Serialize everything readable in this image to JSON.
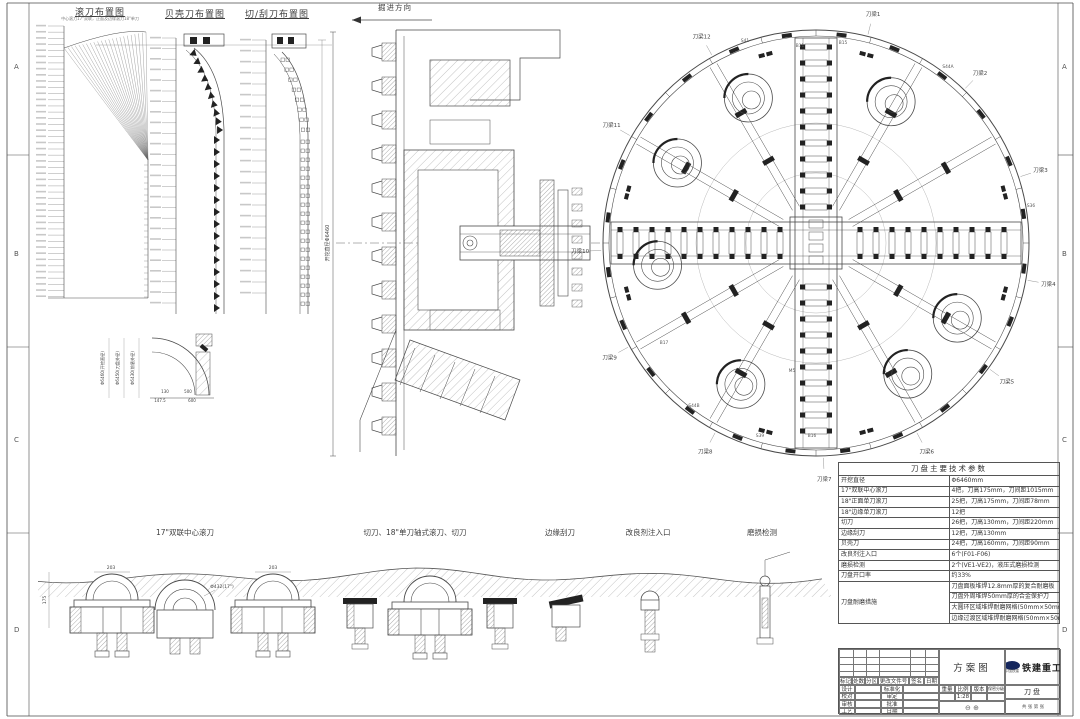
{
  "sheet": {
    "zones": [
      "A",
      "B",
      "C",
      "D"
    ]
  },
  "top_diagrams": {
    "d1_title": "滚刀布置图",
    "d1_subtitle": "中心滚刀17\"双联，正面及边缘滚刀18\"单刀",
    "d2_title": "贝壳刀布置图",
    "d3_title": "切/刮刀布置图"
  },
  "direction_label": "掘进方向",
  "section": {
    "dim_label": "开挖直径Φ6460"
  },
  "detail": {
    "dims": [
      "Φ6460(开挖直径)",
      "Φ6450(刀盘外径)",
      "Φ6430(前盾外径)"
    ],
    "bottom_dims": [
      "130",
      "500",
      "147.5",
      "600"
    ]
  },
  "cutterhead": {
    "beams": [
      {
        "label": "刀梁1",
        "angle": 14
      },
      {
        "label": "刀梁2",
        "angle": 44
      },
      {
        "label": "刀梁3",
        "angle": 72
      },
      {
        "label": "刀梁4",
        "angle": 100
      },
      {
        "label": "刀梁5",
        "angle": 126
      },
      {
        "label": "刀梁6",
        "angle": 152
      },
      {
        "label": "刀梁7",
        "angle": 178
      },
      {
        "label": "刀梁8",
        "angle": 208
      },
      {
        "label": "刀梁9",
        "angle": 241
      },
      {
        "label": "刀梁10",
        "angle": 268
      },
      {
        "label": "刀梁11",
        "angle": 300
      },
      {
        "label": "刀梁12",
        "angle": 331
      }
    ],
    "markers": [
      {
        "label": "S41",
        "x": 745,
        "y": 42
      },
      {
        "label": "S44A",
        "x": 948,
        "y": 68
      },
      {
        "label": "B11",
        "x": 800,
        "y": 47
      },
      {
        "label": "B15",
        "x": 843,
        "y": 44
      },
      {
        "label": "S36",
        "x": 1031,
        "y": 207
      },
      {
        "label": "S39",
        "x": 760,
        "y": 437
      },
      {
        "label": "S44B",
        "x": 694,
        "y": 407
      },
      {
        "label": "B17",
        "x": 664,
        "y": 344
      },
      {
        "label": "B16",
        "x": 812,
        "y": 437
      },
      {
        "label": "M5",
        "x": 792,
        "y": 372
      }
    ]
  },
  "bottom_labels": [
    "17\"双联中心滚刀",
    "切刀、18\"单刀轴式滚刀、切刀",
    "边缘刮刀",
    "改良剂注入口",
    "磨损检测"
  ],
  "bottom_dims": {
    "d203a": "203",
    "d203b": "203",
    "dia": "Φ432(17\")",
    "h175": "175"
  },
  "params_table": {
    "title": "刀盘主要技术参数",
    "rows": [
      [
        "开挖直径",
        "Φ6460mm"
      ],
      [
        "17\"双联中心滚刀",
        "4把，刀高175mm，刀间距1015mm"
      ],
      [
        "18\"正面单刀滚刀",
        "25把，刀高175mm，刀间距78mm"
      ],
      [
        "18\"边缘单刀滚刀",
        "12把"
      ],
      [
        "切刀",
        "26把，刀高130mm，刀间距220mm"
      ],
      [
        "边缘刮刀",
        "12把，刀高130mm"
      ],
      [
        "贝壳刀",
        "24把，刀高160mm，刀间距90mm"
      ],
      [
        "改良剂注入口",
        "6个(F01-F06)"
      ],
      [
        "磨损检测",
        "2个(VE1-VE2)，液压式磨损检测"
      ],
      [
        "刀盘开口率",
        "约33%"
      ]
    ],
    "wear_row": {
      "label": "刀盘耐磨措施",
      "lines": [
        "刀盘面板堆焊12.8mm厚的复合耐磨板",
        "刀盘外周堆焊50mm厚的合金保护刀",
        "大圆环区域堆焊耐磨网格(50mm×50mm，高5mm，宽5mm)",
        "边缘过渡区域堆焊耐磨网格(50mm×50mm，高5mm，宽5mm)"
      ]
    }
  },
  "title_block": {
    "drawing_type": "方案图",
    "company": "铁建重工",
    "company_sub": "中国铁建",
    "part_name": "刀盘",
    "scale": "1:28",
    "header_cells": [
      "标记",
      "处数",
      "分区",
      "更改文件号",
      "签名",
      "日期"
    ],
    "sig_left": [
      "设计",
      "校对",
      "审核",
      "工艺"
    ],
    "sig_right": [
      "标准化",
      "审定",
      "批准",
      "日期"
    ],
    "meta_cells": [
      "重量",
      "比例",
      "版本",
      "保密分级"
    ],
    "sheet_label": "共 张 第 张",
    "projection": "⊖ ⊕"
  }
}
